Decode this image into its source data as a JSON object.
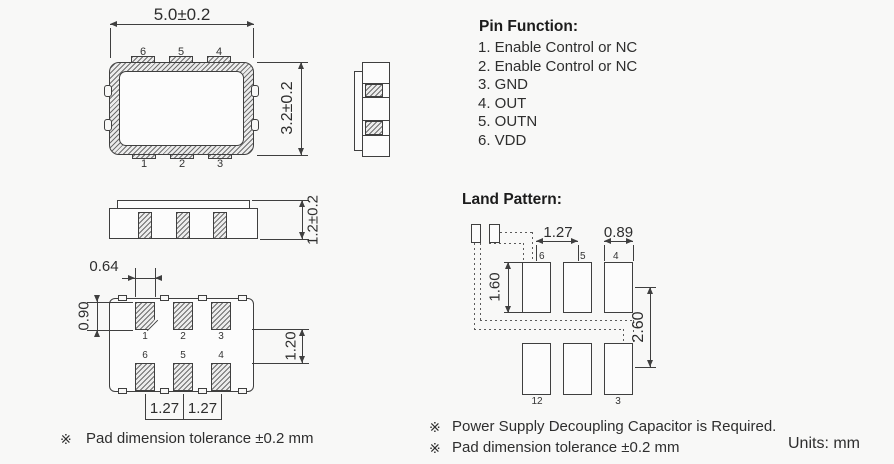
{
  "top_view": {
    "width_dim": "5.0±0.2",
    "height_dim": "3.2±0.2",
    "top_pins": [
      "6",
      "5",
      "4"
    ],
    "bottom_pins": [
      "1",
      "2",
      "3"
    ]
  },
  "front_view": {
    "height_dim": "1.2±0.2"
  },
  "pin_function": {
    "title": "Pin Function:",
    "items": [
      "1. Enable Control or NC",
      "2. Enable Control or NC",
      "3. GND",
      "4. OUT",
      "5. OUTN",
      "6. VDD"
    ]
  },
  "bottom_view": {
    "pad_width_dim": "0.64",
    "pad_height_dim": "0.90",
    "row_gap_dim": "1.20",
    "pitch_dims": [
      "1.27",
      "1.27"
    ],
    "top_row_pins": [
      "1",
      "2",
      "3"
    ],
    "bottom_row_pins": [
      "6",
      "5",
      "4"
    ]
  },
  "land_pattern": {
    "title": "Land Pattern:",
    "pitch_dim": "1.27",
    "pad_width_dim": "0.89",
    "pad_height_dim": "1.60",
    "row_pitch_dim": "2.60",
    "top_row_pins": [
      "6",
      "5",
      "4"
    ],
    "bottom_row_labels": [
      "12",
      "3"
    ]
  },
  "notes": {
    "marker": "※",
    "left_text": "Pad dimension tolerance ±0.2 mm",
    "right_text_1": "Power Supply Decoupling Capacitor is Required.",
    "right_text_2": "Pad dimension tolerance ±0.2 mm",
    "units": "Units: mm"
  },
  "colors": {
    "line": "#3f3f3f",
    "text": "#2e2e2e",
    "background": "#f8f8f7"
  }
}
